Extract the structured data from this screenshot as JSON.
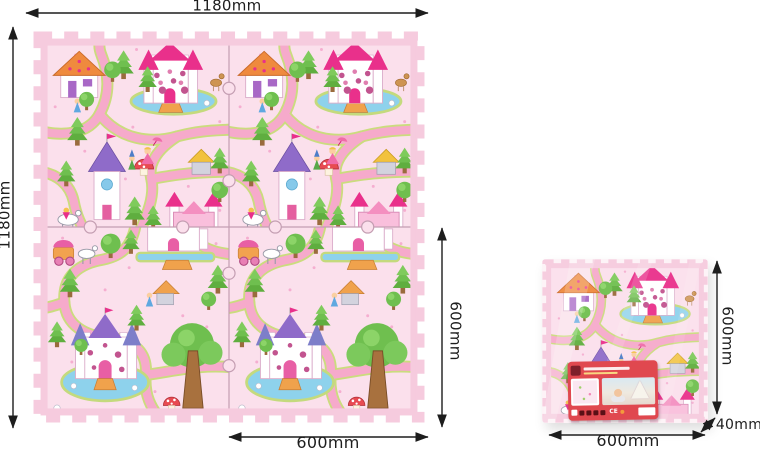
{
  "diagram": {
    "kind": "foam-puzzle-play-mat-dimension-diagram",
    "mat_tiles": "2x2 interlocking tiles, princess castle theme",
    "package": "single shrink-wrapped tile with red product label"
  },
  "dimensions": {
    "mat_overall_width": "1180mm",
    "mat_overall_height": "1180mm",
    "mat_tile_height": "600mm",
    "mat_tile_width": "600mm",
    "package_height": "600mm",
    "package_width": "600mm",
    "package_thickness": "40mm"
  },
  "package_label": {
    "ce_mark": "CE"
  },
  "colors": {
    "background": "#ffffff",
    "dimension_line": "#1d1d1d",
    "mat_edge_pink": "#f6cbde",
    "mat_background": "#fbe0ec",
    "road_pink": "#f6aacb",
    "road_edge_green": "#cbdc7e",
    "water_blue": "#8ed2ec",
    "tree_green": "#6fbf4f",
    "castle_roof_magenta": "#e9308b",
    "castle_roof_purple": "#8f6bc9",
    "label_red": "#e0484f"
  }
}
